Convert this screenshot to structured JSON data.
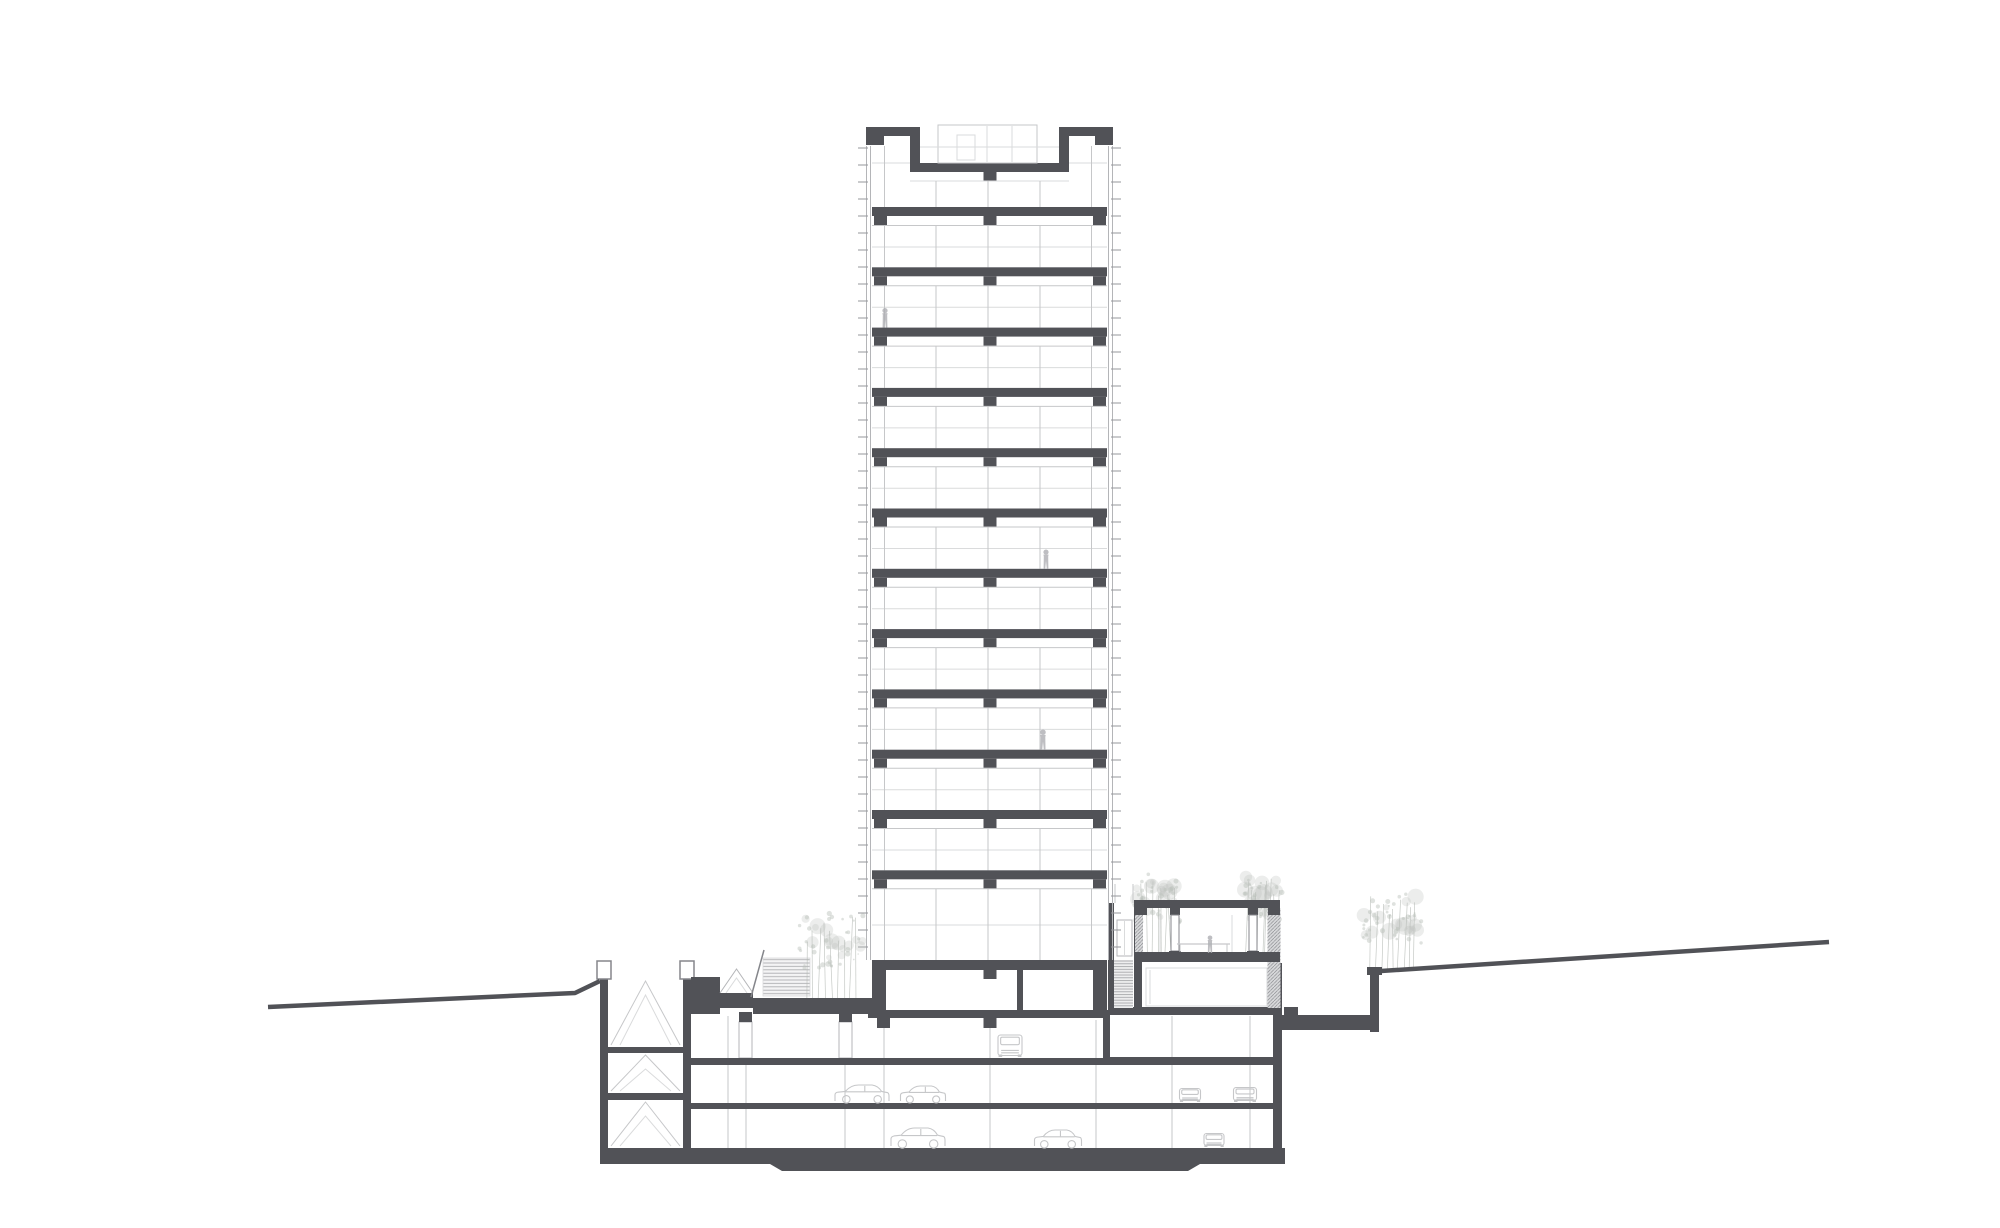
{
  "document": {
    "type": "architectural-cross-section-drawing",
    "subject": "high-rise tower with podium, underground parking and garden pavilion",
    "tower_floors_visible": 12,
    "basement_levels": 3,
    "parking_cars_visible": 8,
    "persons_visible": 4,
    "tree_clusters": 4
  },
  "canvas": {
    "width": 2000,
    "height": 1228,
    "background": "#ffffff"
  },
  "colors": {
    "structure_dark": "#515257",
    "outline_mid": "#85868b",
    "line_light": "#c6c7c9",
    "line_faint": "#dadbdc",
    "facade_edge": "#b4b5b8",
    "tick": "#96979b",
    "tree_fill": "#b9beb9",
    "tree_line": "#b2b7b2",
    "car": "#c6c7c9",
    "person": "#aeafb3",
    "white": "#ffffff"
  },
  "geometry": {
    "tower": {
      "left": 866,
      "right": 1113,
      "slab_left": 872,
      "slab_width": 235,
      "facade_line_top": 146,
      "facade_line_bottom": 960,
      "tick": {
        "top": 148,
        "bottom": 955,
        "spacing": 17,
        "len": 10
      },
      "parapet": {
        "slabs": [
          [
            866,
            127,
            54,
            9
          ],
          [
            1059,
            127,
            54,
            9
          ]
        ],
        "corners": [
          [
            866,
            136,
            18,
            9
          ],
          [
            1095,
            136,
            18,
            9
          ]
        ],
        "walls": [
          [
            910,
            136,
            10,
            30
          ],
          [
            1059,
            136,
            10,
            30
          ]
        ],
        "recess_slab": [
          910,
          163,
          159,
          9
        ],
        "recess_stub": [
          983.5,
          172,
          13,
          9
        ]
      },
      "penthouse": {
        "box": [
          938,
          125,
          99,
          38
        ],
        "door": [
          957,
          135,
          18,
          25
        ],
        "mullions": [
          987,
          1012
        ],
        "railing_y": 147,
        "railing_x": [
          920,
          1059
        ]
      },
      "top_floor": {
        "side_sill_y": 163,
        "side_bays": [
          [
            872,
            910
          ],
          [
            1069,
            1107
          ]
        ],
        "mid_sill_y": 181,
        "mid_span": [
          910,
          1069
        ],
        "side_mullions": [
          884.5,
          1091.5
        ],
        "mid_mullions": [
          936,
          988,
          1040
        ],
        "bottom": 207
      },
      "slabs": {
        "first_top": 207,
        "spacing": 60.3,
        "count": 12,
        "thickness": 9,
        "stub_xs": [
          874,
          983.5,
          1093
        ],
        "stub_w": 13,
        "stub_h": 9
      },
      "story": {
        "head_offset": 18.5,
        "mid_offset": 40,
        "mullions": [
          884.5,
          936,
          988,
          1040,
          1091.5
        ]
      },
      "lobby": {
        "top": 888.8,
        "mid": 925,
        "bottom": 960
      },
      "ground": {
        "slab": [
          872,
          960,
          235,
          10
        ],
        "stub": [
          983.5,
          970,
          13,
          9
        ],
        "side_walls": [
          [
            872,
            970,
            14,
            42
          ],
          [
            1093,
            970,
            14,
            42
          ]
        ],
        "partition": [
          1017,
          970,
          6,
          40
        ]
      }
    },
    "podium": {
      "light_columns": [
        {
          "xs": [
            728,
            746,
            845
          ],
          "y1": 1016,
          "y2": 1148
        },
        {
          "xs": [
            884,
            990,
            1096
          ],
          "y1": 1020,
          "y2": 1148
        },
        {
          "xs": [
            1172,
            1250
          ],
          "y1": 1016,
          "y2": 1148
        }
      ],
      "column_boxes": [
        {
          "cap": [
            739,
            1012,
            13,
            10
          ],
          "shaft": [
            739,
            1022,
            13,
            36
          ]
        },
        {
          "cap": [
            839,
            1012,
            13,
            10
          ],
          "shaft": [
            839,
            1022,
            13,
            36
          ]
        }
      ],
      "ceiling_stubs": [
        [
          877,
          1018,
          13,
          10
        ],
        [
          983.5,
          1018,
          13,
          10
        ]
      ],
      "walls": [
        [
          600,
          977,
          8,
          171
        ],
        [
          683,
          977,
          8,
          171
        ]
      ],
      "wall_caps": [
        [
          597,
          961,
          14,
          18
        ],
        [
          680,
          961,
          14,
          18
        ]
      ],
      "stair_levels": [
        [
          981,
          1045
        ],
        [
          1055,
          1091
        ],
        [
          1102,
          1146
        ]
      ],
      "stair_span": [
        611,
        680
      ],
      "stair_slabs": [
        [
          608,
          1047,
          75,
          6
        ],
        [
          608,
          1093,
          75,
          7
        ]
      ],
      "terrace_block": [
        691,
        977,
        29,
        37
      ],
      "gable": {
        "outer": [
          [
            720,
            993
          ],
          [
            736.5,
            969
          ],
          [
            753,
            993
          ]
        ],
        "inner": [
          [
            726,
            993
          ],
          [
            736.5,
            978
          ],
          [
            747,
            993
          ]
        ],
        "band": [
          718,
          993,
          35,
          15
        ]
      },
      "entry_stairs": [
        763,
        958,
        47,
        38
      ],
      "entry_rail": [
        751,
        997,
        764,
        950
      ],
      "plaza_slab": [
        753,
        998,
        119,
        16
      ],
      "b1_ceilings": [
        [
          868,
          1010,
          242,
          8
        ],
        [
          1110,
          1007,
          172,
          8
        ]
      ],
      "b1_floors": [
        [
          691,
          1058,
          412,
          7
        ],
        [
          1110,
          1057,
          163,
          8
        ]
      ],
      "b1_wall": [
        1103,
        1010,
        7,
        55
      ],
      "b2_floor": [
        691,
        1103,
        582,
        6
      ],
      "foundation_path": "M600,1148 L1285,1148 L1285,1164 L1200,1164 L1188,1171 L782,1171 L770,1164 L600,1164 Z",
      "right_wall": [
        1273,
        963,
        9,
        185
      ],
      "right_wall_hatch": [
        1267.5,
        908,
        13,
        100
      ],
      "patio_slab": [
        1282,
        1015,
        88,
        15
      ],
      "patio_step": [
        1284,
        1007,
        14,
        8
      ],
      "ground_wall": [
        1370,
        974,
        9,
        58
      ],
      "ground_wall_cap": [
        1367,
        967,
        15,
        8
      ]
    },
    "annex": {
      "shaft_walls": [
        [
          1108,
          903,
          6,
          107
        ],
        [
          1134,
          900,
          8,
          108
        ]
      ],
      "cab": [
        1117,
        920,
        15,
        36
      ],
      "cab_line_x": 1124.5,
      "shaft_stairs": [
        1114,
        960,
        19,
        48
      ],
      "upper_lines": [
        [
          1115,
          884,
          1115,
          903
        ],
        [
          1133,
          884,
          1133,
          903
        ]
      ],
      "roof": [
        1135,
        900,
        145,
        8
      ],
      "downstands": [
        [
          1135,
          908,
          12,
          7
        ],
        [
          1170,
          908,
          10,
          7
        ],
        [
          1248,
          908,
          10,
          7
        ],
        [
          1268,
          908,
          12,
          7
        ]
      ],
      "posts": [
        [
          1171,
          915,
          8,
          36
        ],
        [
          1249,
          915,
          8,
          36
        ]
      ],
      "post_bases": [
        [
          1169,
          951,
          12,
          11
        ],
        [
          1247,
          951,
          12,
          11
        ]
      ],
      "left_hatch": [
        1135,
        915,
        8,
        37
      ],
      "floor": [
        1135,
        952,
        145,
        10
      ],
      "glass_mullions": [
        1160,
        1232
      ],
      "railing": {
        "y": 944,
        "x1": 1177,
        "x2": 1230
      },
      "basement_box": [
        1146,
        968,
        121,
        38
      ],
      "basement_line_x": 1150
    },
    "ground_lines": {
      "left": [
        [
          268,
          1007
        ],
        [
          575,
          993
        ],
        [
          600,
          981
        ]
      ],
      "right": [
        [
          1381,
          971
        ],
        [
          1829,
          942
        ]
      ],
      "width": 4.5
    },
    "trees": [
      {
        "cx": 832,
        "base": 998,
        "h": 96,
        "w": 66,
        "seed": 7,
        "front": true
      },
      {
        "cx": 1157,
        "base": 952,
        "h": 88,
        "w": 46,
        "seed": 11,
        "front": false
      },
      {
        "cx": 1262,
        "base": 952,
        "h": 88,
        "w": 40,
        "seed": 23,
        "front": false
      },
      {
        "cx": 1392,
        "base": 969,
        "h": 86,
        "w": 60,
        "seed": 37,
        "front": false
      }
    ],
    "cars": [
      {
        "type": "van",
        "cx": 1010,
        "ground": 1057,
        "w": 26,
        "h": 22
      },
      {
        "type": "side",
        "cx": 862,
        "ground": 1102,
        "w": 56,
        "h": 17
      },
      {
        "type": "side",
        "cx": 923,
        "ground": 1102,
        "w": 47,
        "h": 16
      },
      {
        "type": "front",
        "cx": 1190,
        "ground": 1102,
        "w": 23,
        "h": 15
      },
      {
        "type": "front",
        "cx": 1245,
        "ground": 1102,
        "w": 25,
        "h": 16
      },
      {
        "type": "side",
        "cx": 918,
        "ground": 1147,
        "w": 56,
        "h": 19
      },
      {
        "type": "side",
        "cx": 1058,
        "ground": 1147,
        "w": 49,
        "h": 17
      },
      {
        "type": "front",
        "cx": 1214,
        "ground": 1147,
        "w": 22,
        "h": 15
      }
    ],
    "persons": [
      {
        "cx": 885,
        "foot": 327.5,
        "h": 20
      },
      {
        "cx": 1046,
        "foot": 569,
        "h": 20
      },
      {
        "cx": 1043,
        "foot": 750,
        "h": 21
      },
      {
        "cx": 1210,
        "foot": 953,
        "h": 18
      }
    ]
  }
}
